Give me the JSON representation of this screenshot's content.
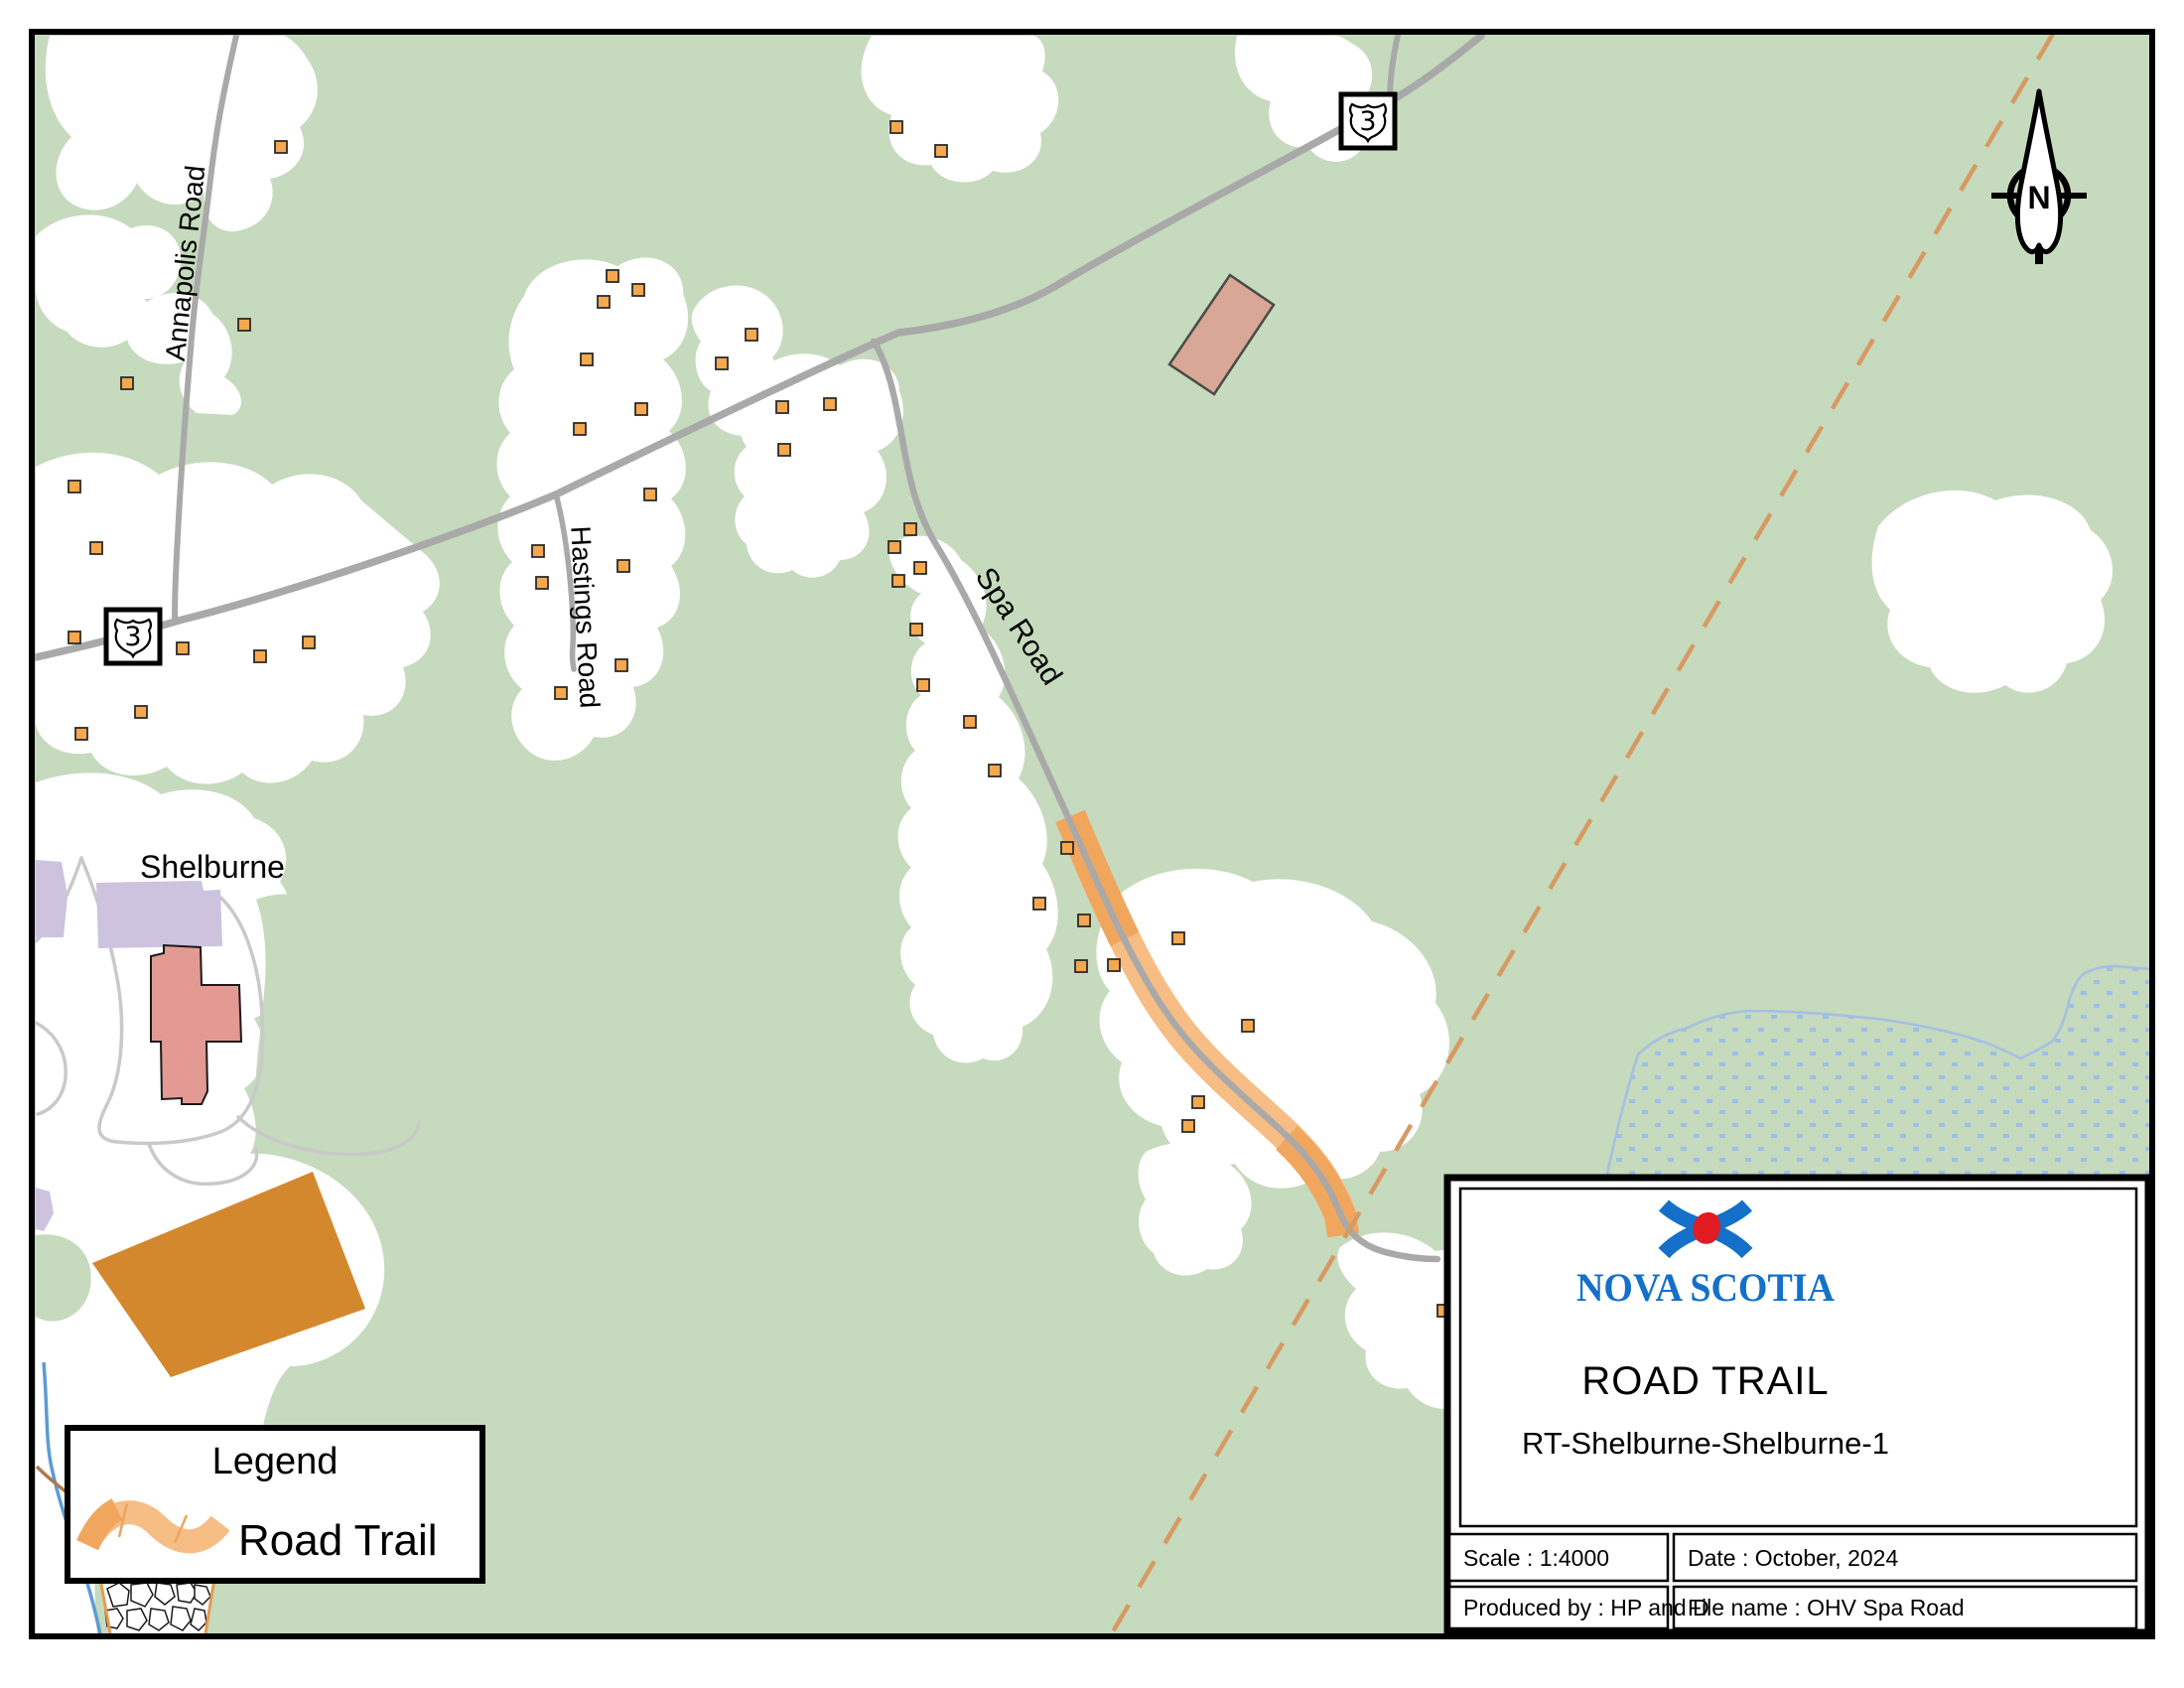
{
  "map": {
    "town_label": "Shelburne",
    "road_labels": {
      "annapolis": "Annapolis Road",
      "hastings": "Hastings Road",
      "spa": "Spa Road"
    },
    "shield_route": "3",
    "north_label": "N"
  },
  "legend": {
    "title": "Legend",
    "items": [
      {
        "symbol": "road-trail-swatch",
        "label": "Road Trail"
      }
    ]
  },
  "title_block": {
    "logo_text": "NOVA SCOTIA",
    "title": "ROAD TRAIL",
    "subtitle": "RT-Shelburne-Shelburne-1",
    "scale": "Scale : 1:4000",
    "date": "Date : October, 2024",
    "produced_by": "Produced by : HP and D",
    "file_name": "File name : OHV Spa Road"
  },
  "colors": {
    "map_background": "#c6dabd",
    "cleared_area": "#ffffff",
    "road_gray": "#a9a9a9",
    "driveway_gray": "#c9c9c9",
    "trail_orange": "#f6bd84",
    "trail_overlap_orange": "#f1a65e",
    "building_orange": "#f6a84e",
    "boundary_dash_orange": "#d79a62",
    "stream_blue": "#5b9bd5",
    "wetland_dot_blue": "#9cc0ea",
    "nova_scotia_blue": "#1470c8",
    "nova_scotia_red": "#e01b22",
    "field_orange": "#d4882e",
    "town_purple": "#cdc3df",
    "building_pink": "#e29a93",
    "farm_tan": "#d8a796"
  }
}
